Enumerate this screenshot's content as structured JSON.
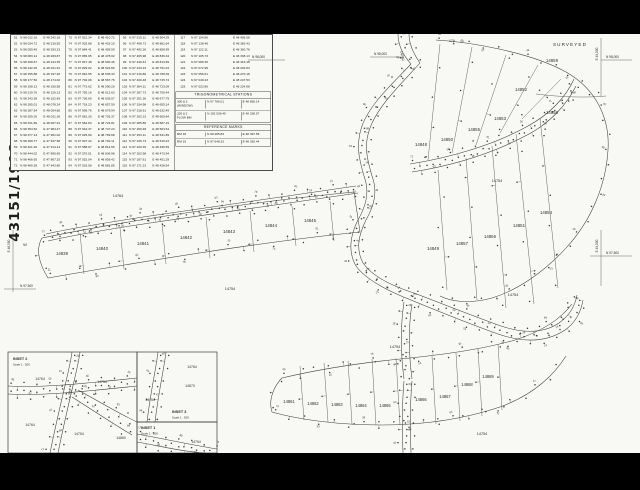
{
  "sheet": {
    "drawing_number": "43151/1998",
    "surveyed_label": "SURVEYED"
  },
  "trig_stations": {
    "title": "TRIGONOMETRICAL STATIONS",
    "rows": [
      {
        "name": "300 Δ 3",
        "sub": "(WINDOW)",
        "n": "N 97 786.01",
        "e": "E 48 856.14"
      },
      {
        "name": "326 Δ 2",
        "sub": "FLOW BM",
        "n": "N 102 536.45",
        "e": "E 48 238.07"
      }
    ]
  },
  "reference_marks": {
    "title": "REFERENCE MARKS",
    "rows": [
      {
        "name": "RM 18",
        "sub": "",
        "n": "N 98 485.83",
        "e": "E 48 397.56"
      },
      {
        "name": "RM 19",
        "sub": "",
        "n": "N 97 648.33",
        "e": "E 48 392.44"
      }
    ]
  },
  "table": {
    "groups": [
      {
        "rows": [
          [
            "51",
            "N 98 012.16",
            "E 48 342.18"
          ],
          [
            "52",
            "N 98 034.72",
            "E 48 316.55"
          ],
          [
            "53",
            "N 98 059.40",
            "E 48 293.23"
          ],
          [
            "54",
            "N 98 083.14",
            "E 48 269.87"
          ],
          [
            "55",
            "N 98 108.67",
            "E 48 244.35"
          ],
          [
            "56",
            "N 98 132.25",
            "E 48 221.91"
          ],
          [
            "57",
            "N 98 155.88",
            "E 48 197.46"
          ],
          [
            "58",
            "N 98 177.50",
            "E 48 174.02"
          ],
          [
            "59",
            "N 98 198.13",
            "E 48 150.58"
          ],
          [
            "60",
            "N 98 219.76",
            "E 48 126.13"
          ],
          [
            "61",
            "N 98 243.38",
            "E 48 102.69"
          ],
          [
            "62",
            "N 98 265.01",
            "E 48 078.24"
          ],
          [
            "63",
            "N 98 287.64",
            "E 48 054.80"
          ],
          [
            "64",
            "N 98 309.26",
            "E 48 031.36"
          ],
          [
            "65",
            "N 98 331.89",
            "E 48 007.91"
          ],
          [
            "66",
            "N 98 354.52",
            "E 47 984.47"
          ],
          [
            "67",
            "N 98 377.14",
            "E 47 961.02"
          ],
          [
            "68",
            "N 98 399.77",
            "E 47 937.58"
          ],
          [
            "69",
            "N 98 421.40",
            "E 47 914.14"
          ],
          [
            "70",
            "N 98 444.02",
            "E 47 890.69"
          ],
          [
            "71",
            "N 98 466.65",
            "E 47 867.25"
          ],
          [
            "72",
            "N 98 489.28",
            "E 47 843.80"
          ]
        ]
      },
      {
        "rows": [
          [
            "73",
            "N 97 921.34",
            "E 48 410.72"
          ],
          [
            "74",
            "N 97 902.88",
            "E 48 433.15"
          ],
          [
            "75",
            "N 97 884.41",
            "E 48 455.59"
          ],
          [
            "76",
            "N 97 865.95",
            "E 48 478.02"
          ],
          [
            "77",
            "N 97 847.48",
            "E 48 500.46"
          ],
          [
            "78",
            "N 97 829.02",
            "E 48 522.89"
          ],
          [
            "79",
            "N 97 810.55",
            "E 48 545.33"
          ],
          [
            "80",
            "N 97 792.09",
            "E 48 567.76"
          ],
          [
            "81",
            "N 97 773.62",
            "E 48 590.20"
          ],
          [
            "82",
            "N 97 755.16",
            "E 48 612.63"
          ],
          [
            "83",
            "N 97 736.69",
            "E 48 635.07"
          ],
          [
            "84",
            "N 97 718.23",
            "E 48 657.50"
          ],
          [
            "85",
            "N 97 699.76",
            "E 48 679.94"
          ],
          [
            "86",
            "N 97 681.30",
            "E 48 702.37"
          ],
          [
            "87",
            "N 97 662.83",
            "E 48 724.81"
          ],
          [
            "88",
            "N 97 644.37",
            "E 48 747.24"
          ],
          [
            "89",
            "N 97 625.90",
            "E 48 769.68"
          ],
          [
            "90",
            "N 97 607.44",
            "E 48 792.11"
          ],
          [
            "91",
            "N 97 588.97",
            "E 48 814.55"
          ],
          [
            "92",
            "N 97 570.51",
            "E 48 836.98"
          ],
          [
            "93",
            "N 97 552.04",
            "E 48 859.42"
          ],
          [
            "94",
            "N 97 533.58",
            "E 48 881.85"
          ]
        ]
      },
      {
        "rows": [
          [
            "95",
            "N 97 515.11",
            "E 48 904.29"
          ],
          [
            "96",
            "N 97 498.73",
            "E 48 881.64"
          ],
          [
            "97",
            "N 97 482.36",
            "E 48 858.99"
          ],
          [
            "98",
            "N 97 465.98",
            "E 48 836.34"
          ],
          [
            "99",
            "N 97 449.61",
            "E 48 813.69"
          ],
          [
            "100",
            "N 97 433.23",
            "E 48 791.04"
          ],
          [
            "101",
            "N 97 416.86",
            "E 48 768.39"
          ],
          [
            "102",
            "N 97 400.48",
            "E 48 745.74"
          ],
          [
            "103",
            "N 97 384.11",
            "E 48 723.09"
          ],
          [
            "104",
            "N 97 367.73",
            "E 48 700.44"
          ],
          [
            "105",
            "N 97 351.36",
            "E 48 677.79"
          ],
          [
            "106",
            "N 97 334.98",
            "E 48 655.14"
          ],
          [
            "107",
            "N 97 318.61",
            "E 48 632.49"
          ],
          [
            "108",
            "N 97 302.23",
            "E 48 609.84"
          ],
          [
            "109",
            "N 97 285.86",
            "E 48 587.19"
          ],
          [
            "110",
            "N 97 269.48",
            "E 48 564.54"
          ],
          [
            "111",
            "N 97 253.11",
            "E 48 541.89"
          ],
          [
            "112",
            "N 97 236.73",
            "E 48 519.24"
          ],
          [
            "113",
            "N 97 220.36",
            "E 48 496.59"
          ],
          [
            "114",
            "N 97 203.98",
            "E 48 473.94"
          ],
          [
            "115",
            "N 97 187.61",
            "E 48 451.29"
          ],
          [
            "116",
            "N 97 171.23",
            "E 48 428.64"
          ]
        ]
      },
      {
        "rows": [
          [
            "117",
            "N 97 154.86",
            "E 48 406.08"
          ],
          [
            "118",
            "N 97 138.48",
            "E 48 383.43"
          ],
          [
            "119",
            "N 97 122.11",
            "E 48 360.78"
          ],
          [
            "120",
            "N 97 105.73",
            "E 48 338.13"
          ],
          [
            "121",
            "N 97 089.36",
            "E 48 315.48"
          ],
          [
            "122",
            "N 97 072.98",
            "E 48 292.83"
          ],
          [
            "123",
            "N 97 056.61",
            "E 48 270.18"
          ],
          [
            "124",
            "N 97 040.23",
            "E 48 247.53"
          ],
          [
            "125",
            "N 97 023.86",
            "E 48 224.88"
          ]
        ]
      }
    ]
  },
  "map": {
    "texts": [
      {
        "n": "lot-label-14839",
        "t": "14839",
        "x": 62,
        "y": 221,
        "s": 4.3
      },
      {
        "n": "lot-label-14840",
        "t": "14840",
        "x": 102,
        "y": 216,
        "s": 4.3
      },
      {
        "n": "lot-label-14841",
        "t": "14841",
        "x": 143,
        "y": 211,
        "s": 4.3
      },
      {
        "n": "lot-label-14842",
        "t": "14842",
        "x": 186,
        "y": 205,
        "s": 4.3
      },
      {
        "n": "lot-label-14843",
        "t": "14843",
        "x": 229,
        "y": 199,
        "s": 4.3
      },
      {
        "n": "lot-label-14844",
        "t": "14844",
        "x": 271,
        "y": 193,
        "s": 4.3
      },
      {
        "n": "lot-label-14845",
        "t": "14845",
        "x": 310,
        "y": 188,
        "s": 4.3
      },
      {
        "n": "lot-label-14848",
        "t": "14848",
        "x": 421,
        "y": 112,
        "s": 4.3
      },
      {
        "n": "lot-label-14850",
        "t": "14850",
        "x": 447,
        "y": 107,
        "s": 4.3
      },
      {
        "n": "lot-label-14855",
        "t": "14855",
        "x": 474,
        "y": 97,
        "s": 4.3
      },
      {
        "n": "lot-label-14853",
        "t": "14853",
        "x": 500,
        "y": 86,
        "s": 4.3
      },
      {
        "n": "lot-label-14852",
        "t": "14852",
        "x": 521,
        "y": 57,
        "s": 4.3
      },
      {
        "n": "lot-label-14858",
        "t": "14858",
        "x": 552,
        "y": 80,
        "s": 4.3
      },
      {
        "n": "lot-label-14859",
        "t": "14859",
        "x": 552,
        "y": 28,
        "s": 4.3
      },
      {
        "n": "lot-label-14849",
        "t": "14849",
        "x": 433,
        "y": 216,
        "s": 4.3
      },
      {
        "n": "lot-label-14857",
        "t": "14857",
        "x": 462,
        "y": 211,
        "s": 4.3
      },
      {
        "n": "lot-label-14856",
        "t": "14856",
        "x": 490,
        "y": 204,
        "s": 4.3
      },
      {
        "n": "lot-label-14851",
        "t": "14851",
        "x": 519,
        "y": 193,
        "s": 4.3
      },
      {
        "n": "lot-label-14854",
        "t": "14854",
        "x": 546,
        "y": 180,
        "s": 4.3
      },
      {
        "n": "lot-label-14861",
        "t": "14861",
        "x": 289,
        "y": 369,
        "s": 4.1
      },
      {
        "n": "lot-label-14862",
        "t": "14862",
        "x": 313,
        "y": 371,
        "s": 4.1
      },
      {
        "n": "lot-label-14863",
        "t": "14863",
        "x": 337,
        "y": 372,
        "s": 4.1
      },
      {
        "n": "lot-label-14864",
        "t": "14864",
        "x": 361,
        "y": 373,
        "s": 4.1
      },
      {
        "n": "lot-label-14865",
        "t": "14865",
        "x": 385,
        "y": 373,
        "s": 4.1
      },
      {
        "n": "lot-label-14866",
        "t": "14866",
        "x": 421,
        "y": 367,
        "s": 4.1
      },
      {
        "n": "lot-label-14867",
        "t": "14867",
        "x": 445,
        "y": 364,
        "s": 4.1
      },
      {
        "n": "lot-label-14868",
        "t": "14868",
        "x": 467,
        "y": 352,
        "s": 4.1
      },
      {
        "n": "lot-label-14869",
        "t": "14869",
        "x": 488,
        "y": 344,
        "s": 4.1
      },
      {
        "n": "road-label-14754-a",
        "t": "14754",
        "x": 230,
        "y": 256,
        "s": 3.8
      },
      {
        "n": "road-label-14764-a",
        "t": "14764",
        "x": 118,
        "y": 163,
        "s": 3.8
      },
      {
        "n": "road-label-14754-b",
        "t": "14754",
        "x": 497,
        "y": 148,
        "s": 3.8
      },
      {
        "n": "road-label-14754-c",
        "t": "14754",
        "x": 513,
        "y": 262,
        "s": 3.8
      },
      {
        "n": "road-label-14754-d",
        "t": "14754",
        "x": 395,
        "y": 314,
        "s": 3.8
      },
      {
        "n": "road-label-14754-e",
        "t": "14754",
        "x": 482,
        "y": 401,
        "s": 3.8
      },
      {
        "n": "road-label-14760",
        "t": "14760",
        "x": 401,
        "y": 22,
        "s": 3.6,
        "r": 78
      },
      {
        "n": "inset2-title",
        "t": "INSET 2",
        "x": 13,
        "y": 326,
        "s": 3.8,
        "a": "s",
        "w": "bold"
      },
      {
        "n": "inset2-scale",
        "t": "Scale 1 : 500",
        "x": 13,
        "y": 331.5,
        "s": 2.9,
        "a": "s"
      },
      {
        "n": "inset3-title",
        "t": "INSET 3",
        "x": 172,
        "y": 379,
        "s": 3.8,
        "a": "s",
        "w": "bold"
      },
      {
        "n": "inset3-scale",
        "t": "Scale 1 : 500",
        "x": 172,
        "y": 384.5,
        "s": 2.9,
        "a": "s"
      },
      {
        "n": "inset1-title",
        "t": "INSET 1",
        "x": 141,
        "y": 395,
        "s": 3.8,
        "a": "s",
        "w": "bold"
      },
      {
        "n": "inset1-scale",
        "t": "Scale 1 : 500",
        "x": 141,
        "y": 400.5,
        "s": 2.9,
        "a": "s"
      },
      {
        "n": "inset-road-label-14764-1",
        "t": "14764",
        "x": 40,
        "y": 346,
        "s": 3.4
      },
      {
        "n": "inset-road-label-14754-1",
        "t": "14754",
        "x": 102,
        "y": 349,
        "s": 3.4
      },
      {
        "n": "inset-road-label-14764-2",
        "t": "14764",
        "x": 30,
        "y": 392,
        "s": 3.4
      },
      {
        "n": "inset-road-label-14754-2",
        "t": "14754",
        "x": 79,
        "y": 401,
        "s": 3.4
      },
      {
        "n": "inset-lot-label-14860",
        "t": "14860",
        "x": 121,
        "y": 405,
        "s": 3.4
      },
      {
        "n": "inset-road-label-14764-3",
        "t": "14764",
        "x": 192,
        "y": 334,
        "s": 3.4
      },
      {
        "n": "inset-lot-label-14873",
        "t": "14873",
        "x": 190,
        "y": 353,
        "s": 3.4
      },
      {
        "n": "inset-road-label-14754-3",
        "t": "14754",
        "x": 150,
        "y": 367,
        "s": 3.4
      },
      {
        "n": "inset-road-label-14764-4",
        "t": "14764",
        "x": 196,
        "y": 409,
        "s": 3.4
      },
      {
        "n": "grid-label-n98000-1",
        "t": "N 98,000",
        "x": 606,
        "y": 24,
        "s": 3.2,
        "a": "s"
      },
      {
        "n": "grid-label-n98000-2",
        "t": "N 98,000",
        "x": 252,
        "y": 24,
        "s": 3.2,
        "a": "s"
      },
      {
        "n": "grid-label-n98000-3",
        "t": "N 98,000",
        "x": 374,
        "y": 21,
        "s": 3.2,
        "a": "s"
      },
      {
        "n": "grid-label-n97500-1",
        "t": "N 97,500",
        "x": 606,
        "y": 220,
        "s": 3.2,
        "a": "s"
      },
      {
        "n": "grid-label-n97500-2",
        "t": "N 97,500",
        "x": 20,
        "y": 253,
        "s": 3.2,
        "a": "s"
      },
      {
        "n": "grid-label-e49000-1",
        "t": "E 49,000",
        "x": 598,
        "y": 20,
        "s": 3.2,
        "r": -90
      },
      {
        "n": "grid-label-e49000-2",
        "t": "E 49,000",
        "x": 598,
        "y": 212,
        "s": 3.2,
        "r": -90
      },
      {
        "n": "grid-label-e46500",
        "t": "E 46,500",
        "x": 10,
        "y": 212,
        "s": 3.2,
        "r": -90
      },
      {
        "n": "surveyed-label",
        "t": "SURVEYED",
        "x": 553,
        "y": 12,
        "s": 4.6,
        "a": "s",
        "sp": 1.1
      },
      {
        "n": "station-label-17a",
        "t": "17A",
        "x": 452,
        "y": 8,
        "s": 3.4
      },
      {
        "n": "margin-mark-w",
        "t": "W",
        "x": 25,
        "y": 212,
        "s": 4
      }
    ]
  }
}
